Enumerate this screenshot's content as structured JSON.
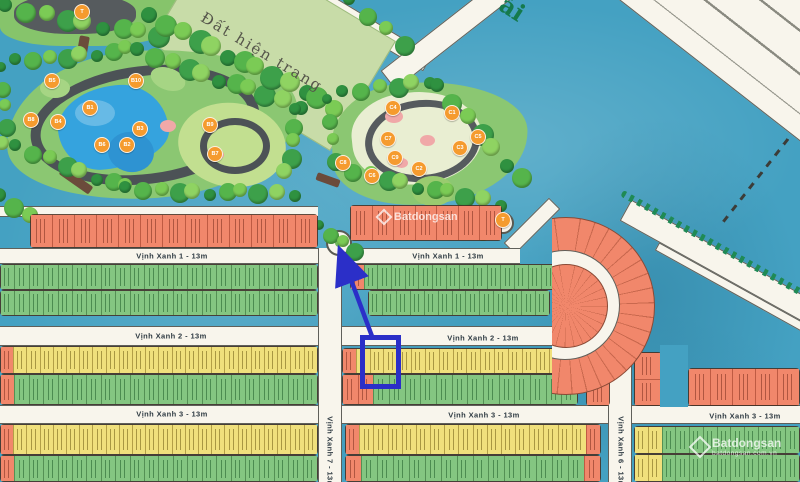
{
  "labels": {
    "field": "Đất hiện trang",
    "river": "ải"
  },
  "watermark": {
    "center": "Batdongsan",
    "brand": "Batdongsan",
    "sub": "batdongsan.com.vn"
  },
  "annotation": {
    "color": "#2B2FC8",
    "rect": {
      "x": 360,
      "y": 335,
      "w": 31,
      "h": 44
    },
    "arrow": {
      "x1": 373,
      "y1": 339,
      "x2": 341,
      "y2": 253
    }
  },
  "street_labels": [
    {
      "text": "Vịnh Xanh 1 - 13m",
      "x": 172,
      "y": 256,
      "rot": 0
    },
    {
      "text": "Vịnh Xanh 1 - 13m",
      "x": 448,
      "y": 256,
      "rot": 0
    },
    {
      "text": "Vịnh Xanh 2 - 13m",
      "x": 171,
      "y": 336,
      "rot": 0
    },
    {
      "text": "Vịnh Xanh 2 - 13m",
      "x": 483,
      "y": 338,
      "rot": 0
    },
    {
      "text": "Vịnh Xanh 3 - 13m",
      "x": 172,
      "y": 414,
      "rot": 0
    },
    {
      "text": "Vịnh Xanh 3 - 13m",
      "x": 484,
      "y": 415,
      "rot": 0
    },
    {
      "text": "Vịnh Xanh 3 - 13m",
      "x": 745,
      "y": 416,
      "rot": 0
    },
    {
      "text": "Vịnh Xanh 7 - 13m",
      "x": 330,
      "y": 452,
      "rot": 90
    },
    {
      "text": "Vịnh Xanh 6 - 13m",
      "x": 621,
      "y": 452,
      "rot": 90
    }
  ],
  "roads": {
    "horizontal": [
      {
        "x": 0,
        "y": 206,
        "w": 318,
        "h": 11
      },
      {
        "x": 0,
        "y": 248,
        "w": 520,
        "h": 16
      },
      {
        "x": 0,
        "y": 326,
        "w": 610,
        "h": 20
      },
      {
        "x": 0,
        "y": 405,
        "w": 800,
        "h": 19
      }
    ],
    "vertical": [
      {
        "x": 318,
        "y": 248,
        "w": 24,
        "h": 234
      },
      {
        "x": 608,
        "y": 330,
        "w": 24,
        "h": 152
      }
    ],
    "diagonal": [
      {
        "cx": 372,
        "cy": 30,
        "w": 130,
        "h": 18,
        "rot": 31,
        "lanes": false
      },
      {
        "cx": 455,
        "cy": 28,
        "w": 170,
        "h": 24,
        "rot": -38,
        "lanes": false
      },
      {
        "cx": 532,
        "cy": 226,
        "w": 64,
        "h": 16,
        "rot": -45,
        "lanes": false
      },
      {
        "cx": 755,
        "cy": 30,
        "w": 460,
        "h": 120,
        "rot": 38,
        "lanes": true
      },
      {
        "cx": 748,
        "cy": 278,
        "w": 280,
        "h": 24,
        "rot": 29,
        "lanes": false
      },
      {
        "cx": 762,
        "cy": 304,
        "w": 240,
        "h": 9,
        "rot": 29,
        "lanes": false
      }
    ],
    "embankment": {
      "cx": 740,
      "cy": 258,
      "w": 270,
      "rot": 29
    },
    "dashes": [
      {
        "cx": 757,
        "cy": 178,
        "w": 110,
        "rot": -52
      }
    ]
  },
  "lot_rows": [
    {
      "x": 30,
      "y": 214,
      "w": 288,
      "h": 34,
      "n": 13,
      "color": "orange"
    },
    {
      "x": 0,
      "y": 264,
      "w": 318,
      "h": 26,
      "n": 22,
      "color": "green"
    },
    {
      "x": 0,
      "y": 290,
      "w": 318,
      "h": 26,
      "n": 22,
      "color": "green"
    },
    {
      "x": 0,
      "y": 346,
      "w": 318,
      "h": 28,
      "n": 24,
      "color": "yellow",
      "capsLeft": [
        "orange"
      ]
    },
    {
      "x": 0,
      "y": 374,
      "w": 318,
      "h": 31,
      "n": 22,
      "color": "green",
      "capsLeft": [
        "orange"
      ]
    },
    {
      "x": 0,
      "y": 424,
      "w": 318,
      "h": 31,
      "n": 24,
      "color": "yellow",
      "capsLeft": [
        "orange"
      ]
    },
    {
      "x": 0,
      "y": 455,
      "w": 318,
      "h": 27,
      "n": 22,
      "color": "green",
      "capsLeft": [
        "orange"
      ]
    },
    {
      "x": 350,
      "y": 205,
      "w": 152,
      "h": 36,
      "n": 7,
      "color": "orange"
    },
    {
      "x": 350,
      "y": 264,
      "w": 206,
      "h": 26,
      "n": 15,
      "color": "green",
      "capsLeft": [
        "orange"
      ]
    },
    {
      "x": 368,
      "y": 290,
      "w": 182,
      "h": 26,
      "n": 13,
      "color": "green"
    },
    {
      "x": 342,
      "y": 348,
      "w": 236,
      "h": 26,
      "n": 17,
      "color": "yellow",
      "capsLeft": [
        "orange"
      ]
    },
    {
      "x": 342,
      "y": 374,
      "w": 236,
      "h": 31,
      "n": 15,
      "color": "green",
      "capsLeft": [
        "orange",
        "orange"
      ]
    },
    {
      "x": 345,
      "y": 424,
      "w": 256,
      "h": 31,
      "n": 18,
      "color": "yellow",
      "capsLeft": [
        "orange"
      ],
      "capsRight": [
        "orange"
      ]
    },
    {
      "x": 345,
      "y": 455,
      "w": 256,
      "h": 27,
      "n": 16,
      "color": "green",
      "capsLeft": [
        "orange"
      ],
      "capsRight": [
        "orange"
      ]
    },
    {
      "x": 586,
      "y": 332,
      "w": 24,
      "h": 74,
      "n": 3,
      "color": "orange",
      "stack": true
    },
    {
      "x": 634,
      "y": 352,
      "w": 28,
      "h": 54,
      "n": 2,
      "color": "orange",
      "stack": true
    },
    {
      "x": 688,
      "y": 368,
      "w": 112,
      "h": 38,
      "n": 5,
      "color": "orange"
    },
    {
      "x": 634,
      "y": 426,
      "w": 166,
      "h": 28,
      "n": 12,
      "color": "green",
      "capsLeft": [
        "yellow",
        "yellow"
      ]
    },
    {
      "x": 634,
      "y": 454,
      "w": 166,
      "h": 28,
      "n": 12,
      "color": "green",
      "capsLeft": [
        "yellow",
        "yellow"
      ]
    }
  ],
  "park_markers": [
    {
      "label": "T",
      "x": 82,
      "y": 12
    },
    {
      "label": "B5",
      "x": 52,
      "y": 81
    },
    {
      "label": "B10",
      "x": 136,
      "y": 81
    },
    {
      "label": "B1",
      "x": 90,
      "y": 108
    },
    {
      "label": "B8",
      "x": 31,
      "y": 120
    },
    {
      "label": "B4",
      "x": 58,
      "y": 122
    },
    {
      "label": "B3",
      "x": 140,
      "y": 129
    },
    {
      "label": "B9",
      "x": 210,
      "y": 125
    },
    {
      "label": "B6",
      "x": 102,
      "y": 145
    },
    {
      "label": "B2",
      "x": 127,
      "y": 145
    },
    {
      "label": "B7",
      "x": 215,
      "y": 154
    },
    {
      "label": "C4",
      "x": 393,
      "y": 108
    },
    {
      "label": "C1",
      "x": 452,
      "y": 113
    },
    {
      "label": "C7",
      "x": 388,
      "y": 139
    },
    {
      "label": "C5",
      "x": 478,
      "y": 137
    },
    {
      "label": "C3",
      "x": 460,
      "y": 148
    },
    {
      "label": "C8",
      "x": 343,
      "y": 163
    },
    {
      "label": "C9",
      "x": 395,
      "y": 158
    },
    {
      "label": "C2",
      "x": 419,
      "y": 169
    },
    {
      "label": "C6",
      "x": 372,
      "y": 176
    },
    {
      "label": "T",
      "x": 503,
      "y": 220
    }
  ],
  "tree_lines": [
    [
      8,
      8,
      160,
      36,
      9,
      9
    ],
    [
      18,
      62,
      128,
      50,
      8,
      8
    ],
    [
      140,
      52,
      298,
      106,
      11,
      9
    ],
    [
      298,
      112,
      286,
      172,
      5,
      8
    ],
    [
      18,
      148,
      128,
      188,
      8,
      8
    ],
    [
      128,
      190,
      292,
      194,
      11,
      8
    ],
    [
      4,
      70,
      4,
      144,
      5,
      7
    ],
    [
      152,
      18,
      334,
      106,
      13,
      10
    ],
    [
      352,
      2,
      402,
      44,
      4,
      8
    ],
    [
      345,
      94,
      430,
      80,
      6,
      8
    ],
    [
      440,
      88,
      520,
      178,
      7,
      9
    ],
    [
      338,
      168,
      498,
      204,
      11,
      8
    ],
    [
      330,
      102,
      333,
      160,
      4,
      7
    ],
    [
      2,
      198,
      42,
      226,
      4,
      9
    ],
    [
      322,
      228,
      352,
      250,
      4,
      7
    ],
    [
      476,
      226,
      484,
      232,
      2,
      7
    ]
  ],
  "tree_colors": [
    "#2F9140",
    "#55B44B",
    "#7BCB55",
    "#3DA04A",
    "#8FD362"
  ]
}
